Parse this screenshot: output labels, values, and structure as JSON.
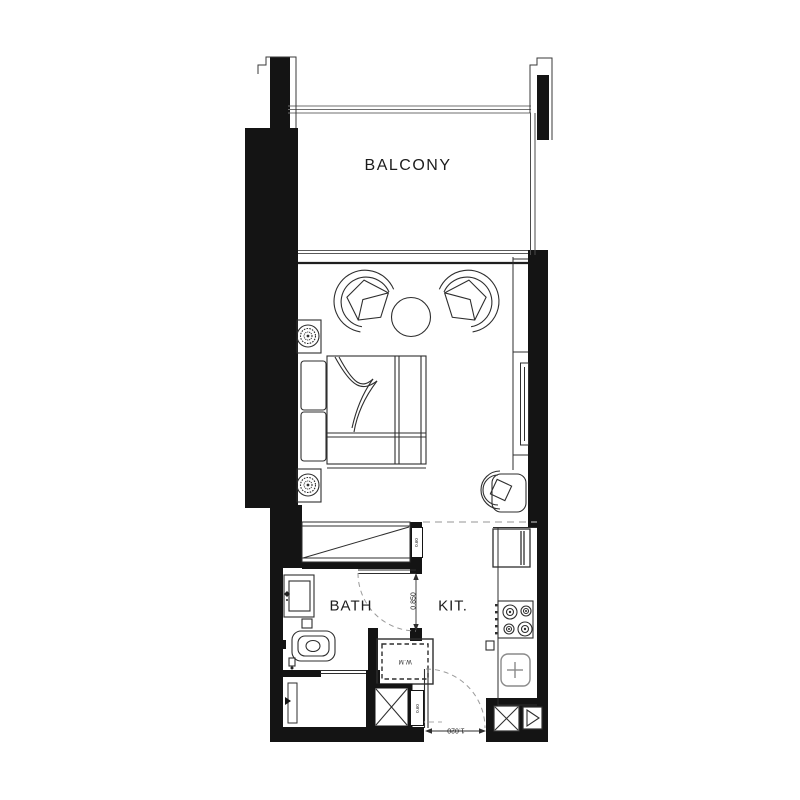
{
  "labels": {
    "balcony": "BALCONY",
    "bath": "BATH",
    "kitchen": "KIT.",
    "washing_machine": "W.M"
  },
  "dimensions": {
    "bath_door": "0.850",
    "entry_door": "1.020",
    "shaft_top": "0.60",
    "shaft_bottom": "0.60"
  },
  "colors": {
    "wall": "#141414",
    "line": "#2e2e2e",
    "light_line": "#8c8c8c",
    "dashed": "#aaaaaa",
    "background": "#ffffff"
  }
}
